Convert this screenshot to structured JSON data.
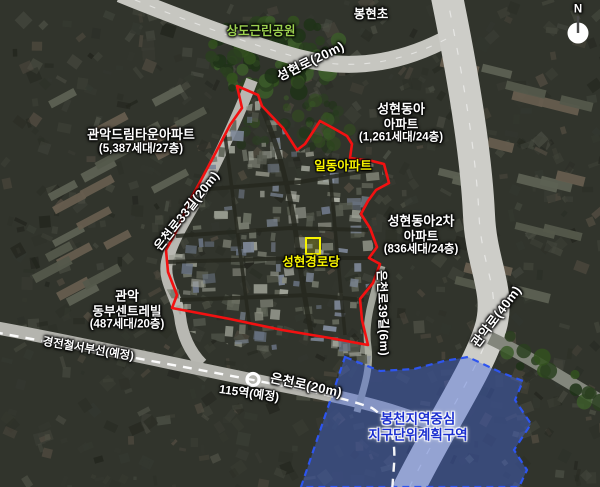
{
  "labels": {
    "north": "N",
    "park": "상도근린공원",
    "school": "봉현초"
  },
  "roads": {
    "seonghyeon": "성현로(20m)",
    "euncheon33": "은천로33길(20m)",
    "euncheon": "은천로(20m)",
    "euncheon39": "은천로39길(6m)",
    "gwanak": "관악로(40m)"
  },
  "rail": {
    "line": "경전철서부선(예정)",
    "station": "115역(예정)"
  },
  "sites": {
    "dreamtown": {
      "lines": [
        "관악드림타운아파트",
        "(5,387세대/27층)"
      ]
    },
    "seonghyeon_donga": {
      "lines": [
        "성현동아",
        "아파트",
        "(1,261세대/24층)"
      ]
    },
    "ildong": {
      "lines": [
        "일동아파트"
      ]
    },
    "seonghyeon_donga2": {
      "lines": [
        "성현동아2차",
        "아파트",
        "(836세대/24층)"
      ]
    },
    "gwanak_centreville": {
      "lines": [
        "관악",
        "동부센트레빌",
        "(487세대/20층)"
      ]
    },
    "senior_center": {
      "lines": [
        "성현경로당"
      ]
    }
  },
  "district": {
    "lines": [
      "봉천지역중심",
      "지구단위계획구역"
    ]
  },
  "colors": {
    "boundary": "#f31111",
    "district_border": "#2d55f0",
    "district_fill": "#4668e0",
    "district_text": "#1b2fd0",
    "highlight_text": "#f8f400",
    "park_text": "#9cd14f",
    "rail_dash": "#ffffff"
  }
}
